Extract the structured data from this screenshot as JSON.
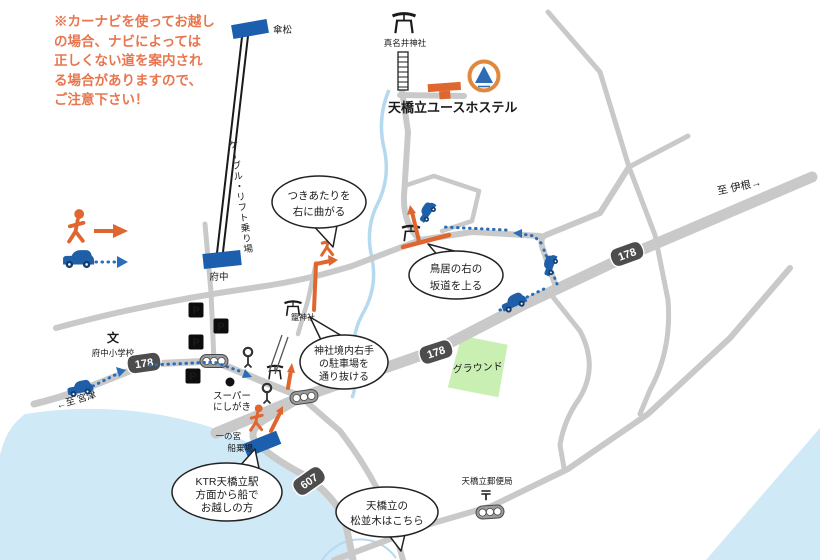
{
  "note": {
    "lines": [
      "※カーナビを使ってお越し",
      "の場合、ナビによっては",
      "正しくない道を案内され",
      "る場合がありますので、",
      "ご注意下さい！"
    ]
  },
  "labels": {
    "kasamatsu": "傘松",
    "cable_lift": "ケーブル・リフト乗り場",
    "fuchu_station": "府中",
    "manai_shrine": "真名井神社",
    "hostel": "天橋立ユースホステル",
    "kono_shrine": "籠神社",
    "super_l1": "スーパー",
    "super_l2": "にしがき",
    "pier_l1": "一の宮",
    "pier_l2": "船乗場",
    "school_mark": "文",
    "school": "府中小学校",
    "ground": "グラウンド",
    "post_office": "天橋立郵便局",
    "post_mark": "〒",
    "to_ine": "至 伊根→",
    "to_miyazu": "←至 宮津",
    "parking": "P"
  },
  "bubbles": {
    "turn_right": {
      "l1": "つきあたりを",
      "l2": "右に曲がる"
    },
    "slope": {
      "l1": "鳥居の右の",
      "l2": "坂道を上る"
    },
    "shrine_parking": {
      "l1": "神社境内右手",
      "l2": "の駐車場を",
      "l3": "通り抜ける"
    },
    "ktr": {
      "l1": "KTR天橋立駅",
      "l2": "方面から船で",
      "l3": "お越しの方"
    },
    "pine": {
      "l1": "天橋立の",
      "l2": "松並木はこちら"
    }
  },
  "routes": {
    "r178": "178",
    "r607": "607"
  },
  "colors": {
    "walk_orange": "#e0662f",
    "car_blue": "#1f5fa8",
    "road_gray": "#c9c9c9",
    "water_blue": "#cfe9f7",
    "ground_green": "#c9efb3",
    "badge_gray": "#4d4d4d",
    "note_text": "#e8764f",
    "hostel_blue": "#1b5fae"
  }
}
